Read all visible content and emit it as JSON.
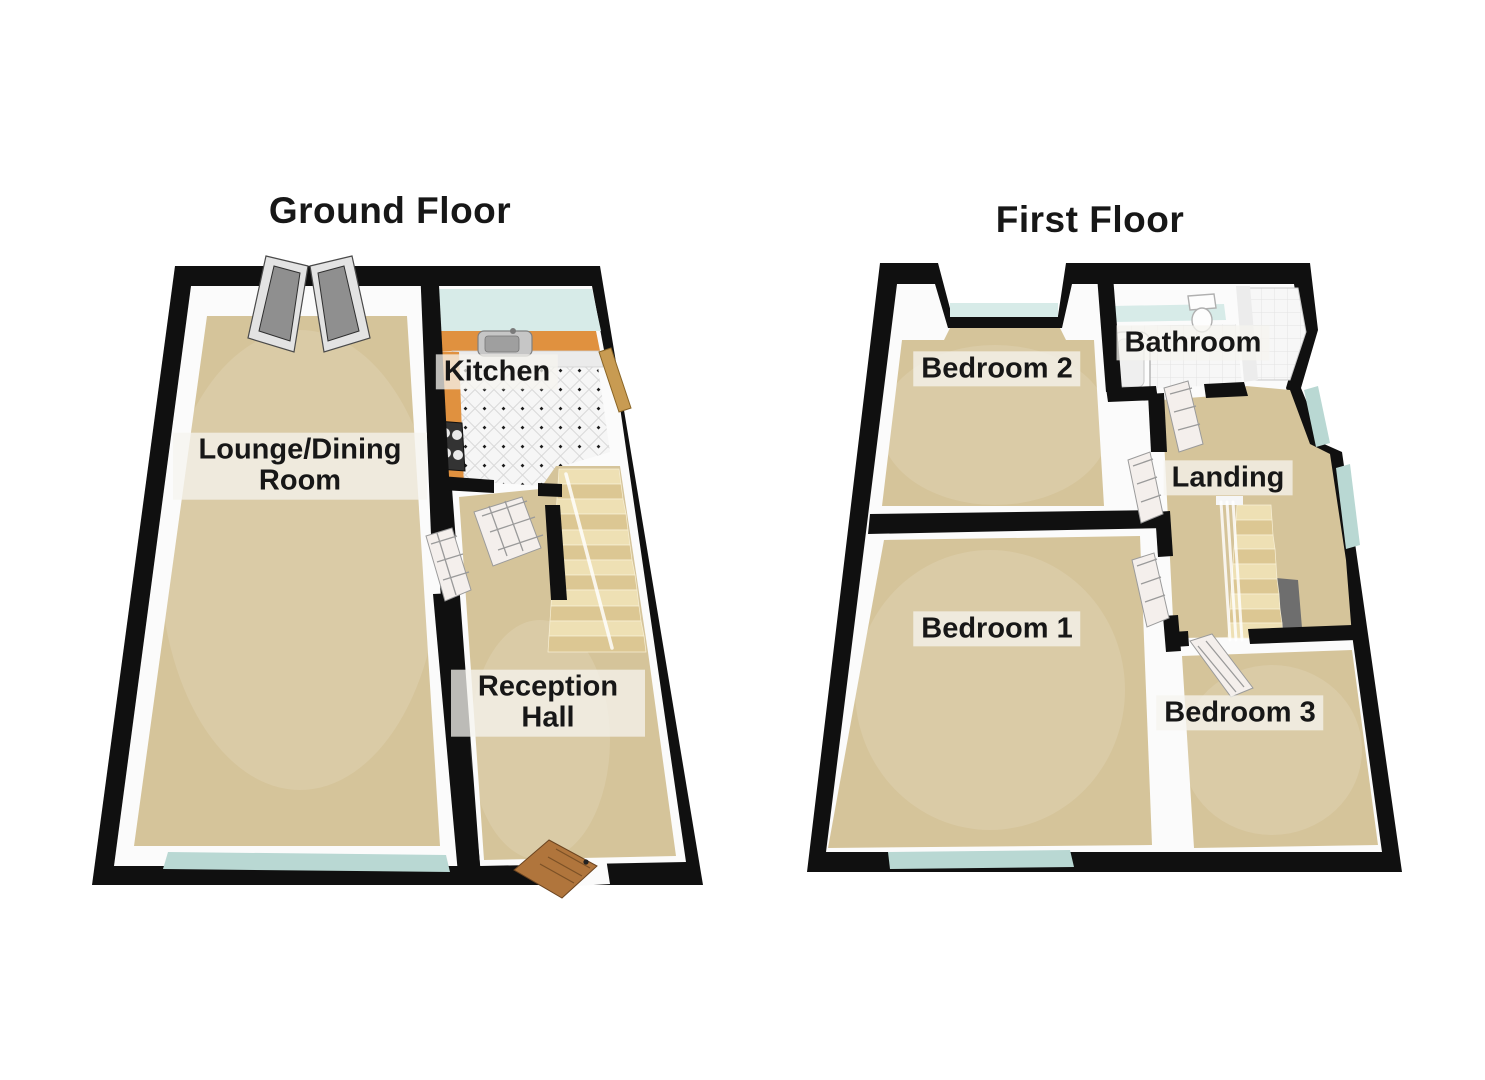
{
  "floors": [
    {
      "title": "Ground Floor",
      "rooms": [
        {
          "label": "Lounge/Dining Room"
        },
        {
          "label": "Kitchen"
        },
        {
          "label": "Reception Hall"
        }
      ]
    },
    {
      "title": "First Floor",
      "rooms": [
        {
          "label": "Bedroom 2"
        },
        {
          "label": "Bathroom"
        },
        {
          "label": "Landing"
        },
        {
          "label": "Bedroom 1"
        },
        {
          "label": "Bedroom 3"
        }
      ]
    }
  ],
  "palette": {
    "wall": "#101010",
    "shell": "#fbfbfb",
    "carpet": "#d5c49a",
    "carpet_edge": "#c3ae80",
    "counter": "#e0913f",
    "cabinet": "#ebebeb",
    "stair_light": "#eee0b4",
    "stair_dark": "#dcc793",
    "stair_void": "#6e6e6e",
    "glass": "#d7ebe8",
    "glass_deep": "#b9d8d3",
    "tile_line": "#d9d9d9",
    "tile_dot": "#1b1b1b",
    "door_gray_frame": "#e3e3e3",
    "door_gray_panel": "#8f8f8f",
    "door_white": "#f4efec",
    "door_pane": "#9a9a9a",
    "wood_front_door": "#b0753c",
    "wood_side_door": "#c89b52",
    "label_bg": "rgba(245,244,239,0.75)",
    "ink": "#171717"
  }
}
